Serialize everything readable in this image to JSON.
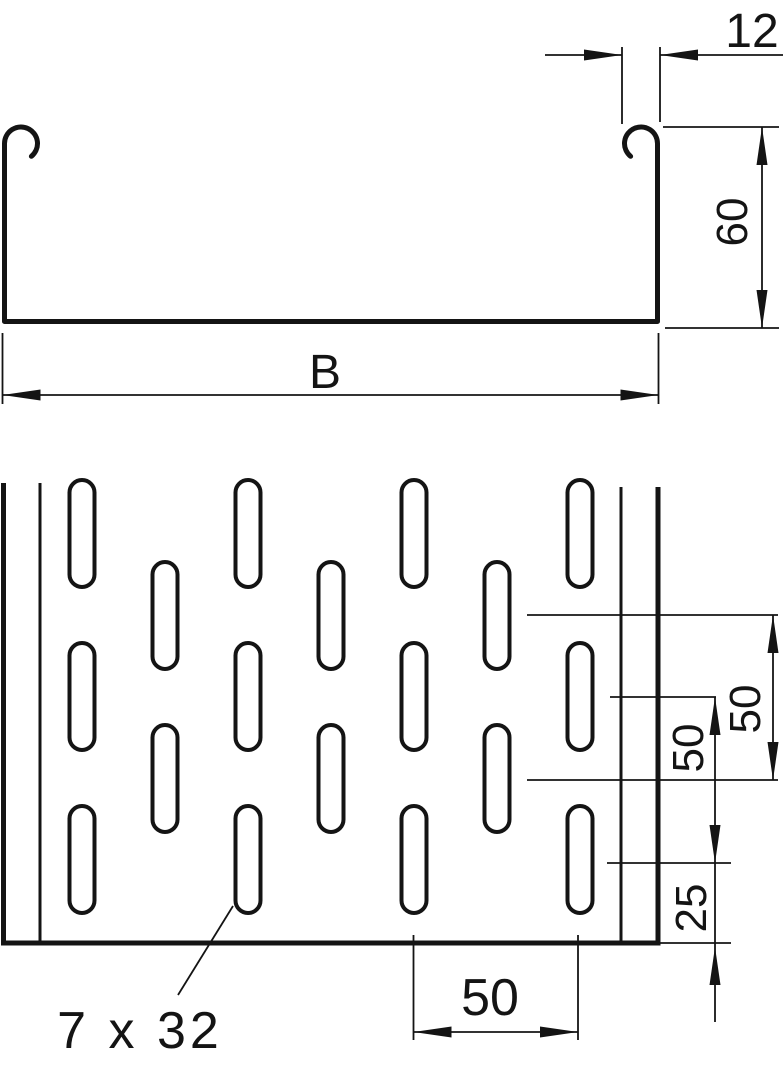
{
  "section_view": {
    "dim_lip_width": "12",
    "dim_side_height": "60",
    "dim_overall_width": "B"
  },
  "plan_view": {
    "dim_row_offset": "50",
    "dim_row_pitch": "50",
    "dim_end_distance": "25",
    "dim_slot_column_pitch": "50",
    "slot_size_label": "7 x 32"
  },
  "colors": {
    "line": "#141414",
    "background": "#ffffff"
  }
}
